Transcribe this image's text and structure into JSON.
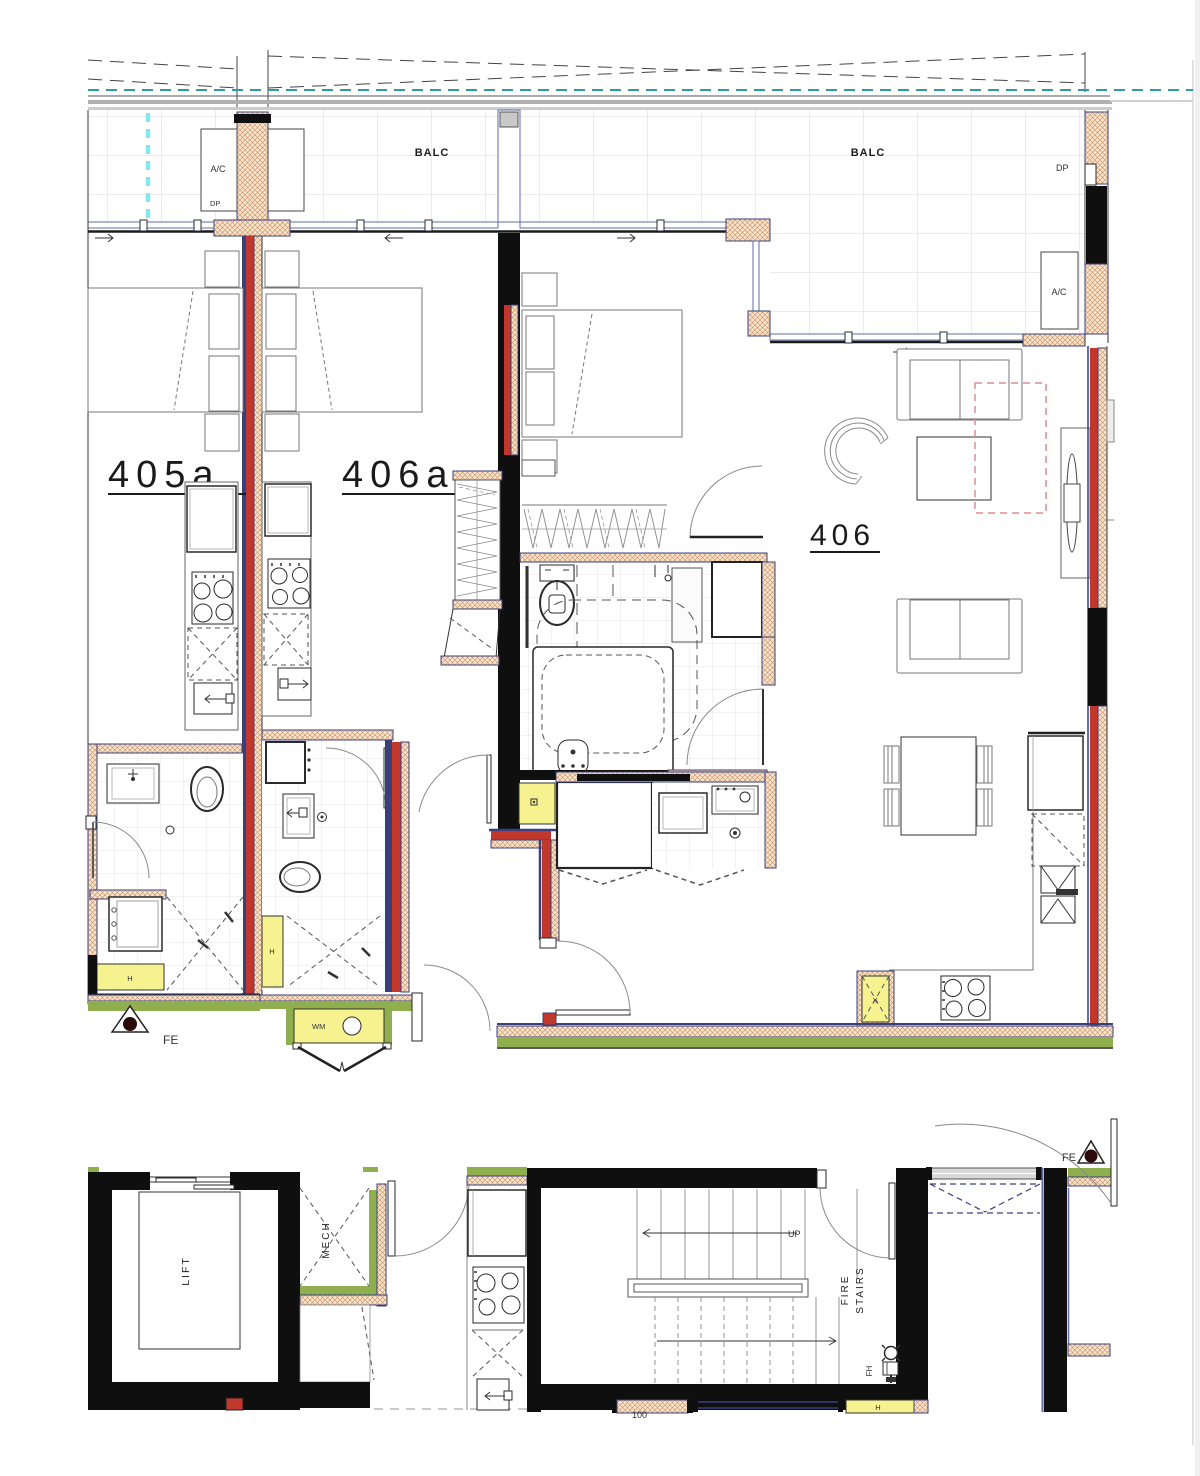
{
  "title": "Floor plan – units 405a / 406a / 406 with service core",
  "colors": {
    "wall-red": "#c2372c",
    "wall-navy": "#3a3f7c",
    "window-blue": "#5d6ca8",
    "wall-black": "#0f0f0f",
    "hatch-bg": "#f6e3cb",
    "hatch-line": "#c98f63",
    "green": "#8fae4e",
    "yellow": "#f6f290",
    "cyan": "#86e8ef",
    "teal": "#2f9ca4",
    "rose-dashed": "#dd8d8d",
    "grid-gray": "#d9d9d9"
  },
  "labels": {
    "balc": "BALC",
    "ac": "A/C",
    "dp": "DP",
    "unit_405a": "405a",
    "unit_406a": "406a",
    "unit_406": "406",
    "fe": "FE",
    "wm": "WM",
    "h": "H",
    "x_marker": "X",
    "lift": "LIFT",
    "mech": "MECH",
    "fire_stairs_1": "FIRE",
    "fire_stairs_2": "STAIRS",
    "up": "UP",
    "fh": "FH",
    "dim_100": "100"
  }
}
